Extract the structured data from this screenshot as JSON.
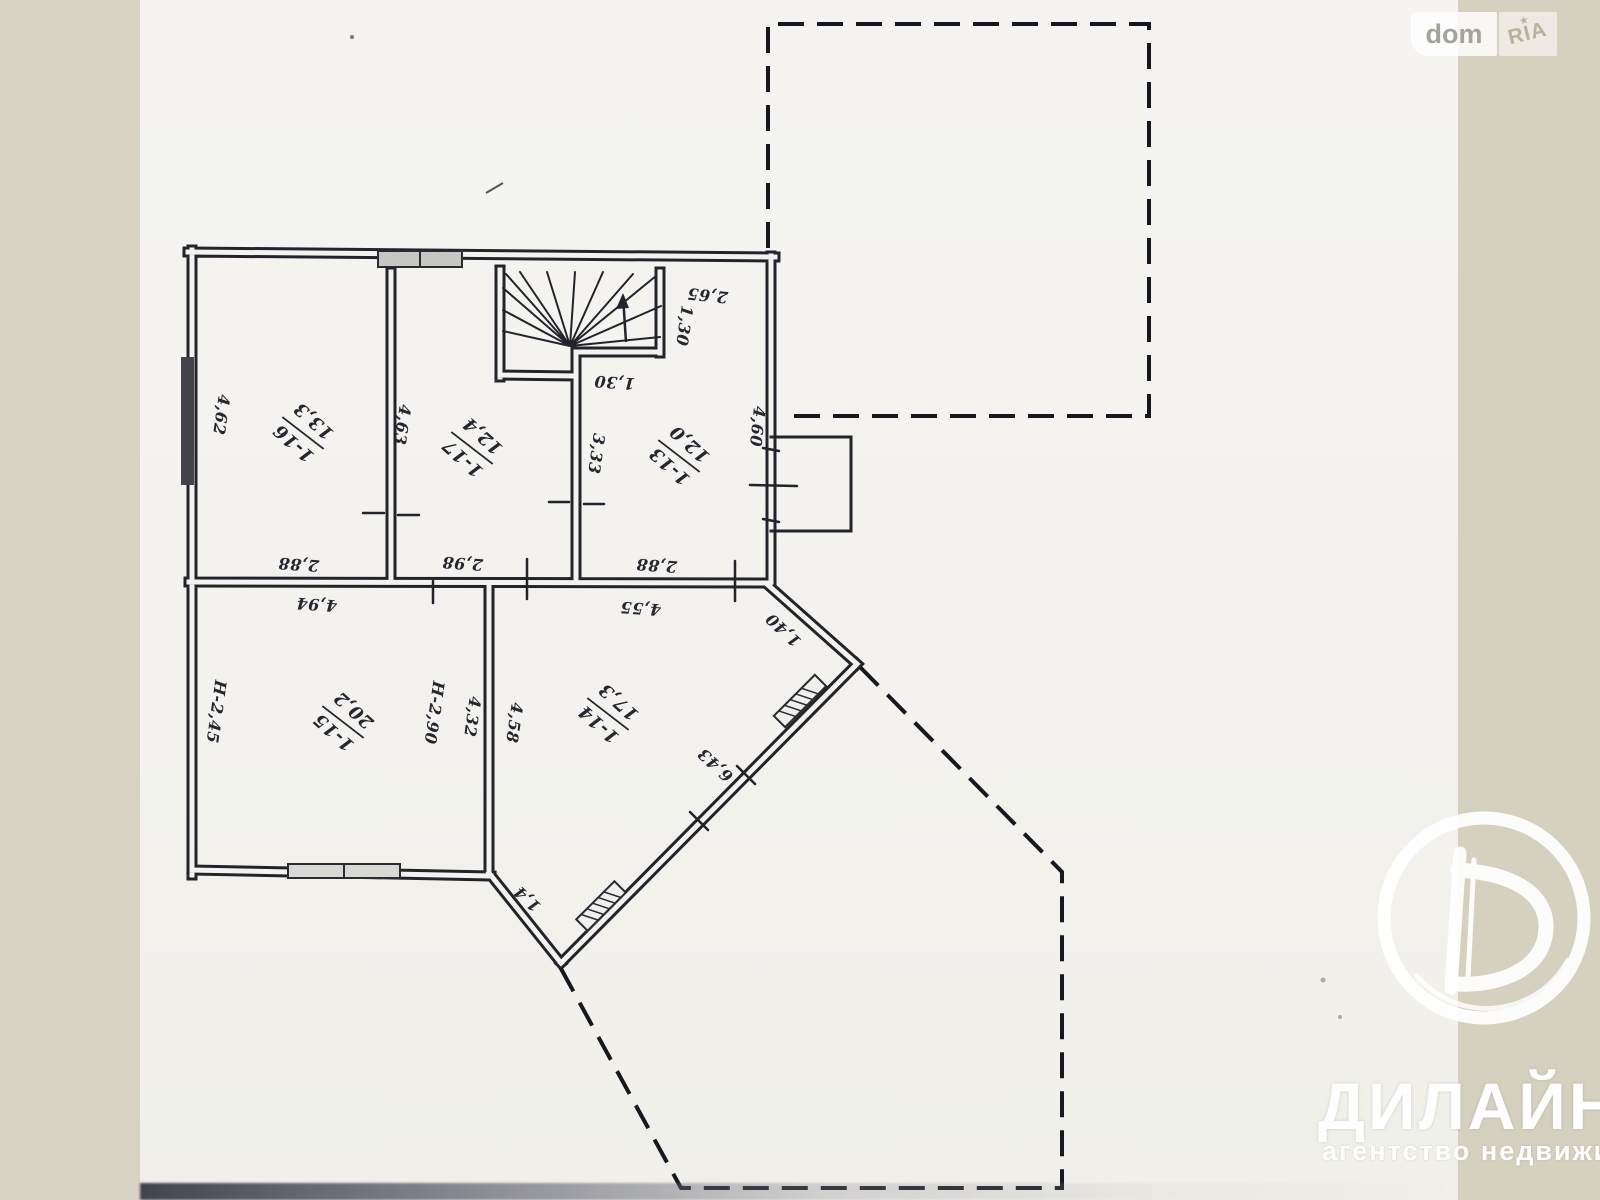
{
  "site_watermark": {
    "left": "dom",
    "right": "RIA"
  },
  "agency_watermark": {
    "name": "ДИЛАЙН",
    "tagline": "агентство недвижимо"
  },
  "floor_plan": {
    "rooms": [
      {
        "number": "1-16",
        "area": "13,3"
      },
      {
        "number": "1-17",
        "area": "12,4"
      },
      {
        "number": "1-13",
        "area": "12,0"
      },
      {
        "number": "1-15",
        "area": "20,2"
      },
      {
        "number": "1-14",
        "area": "17,3"
      }
    ],
    "dimensions": {
      "room16_left_wall": "4,62",
      "wall_16_17": "4,63",
      "wall_17_13": "3,33",
      "stairs_width_top": "2,65",
      "stairs_depth_right": "1,30",
      "stairs_landing": "1,30",
      "right_wall": "4,60",
      "room16_bottom": "2,88",
      "room17_bottom": "2,98",
      "room13_bottom": "2,88",
      "room15_top": "4,94",
      "room14_top": "4,55",
      "wall_15_14_upper": "4,32",
      "wall_15_14_lower": "4,58",
      "diagonal_ne": "1,40",
      "diagonal_se": "6,43",
      "diagonal_sw": "1,4",
      "room15_height_left": "H-2,45",
      "room15_height_mid": "H-2,90"
    }
  }
}
